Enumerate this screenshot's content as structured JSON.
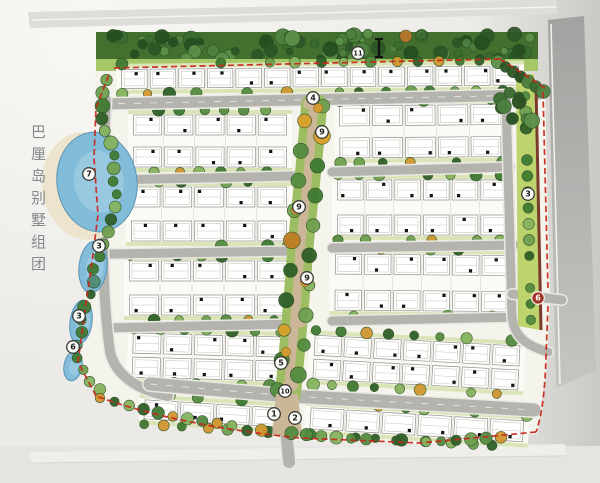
{
  "title": {
    "text": "巴厘岛别墅组团"
  },
  "legend_markers": [
    {
      "label": "11",
      "x": 358,
      "y": 53
    },
    {
      "label": "4",
      "x": 313,
      "y": 98
    },
    {
      "label": "9",
      "x": 322,
      "y": 132
    },
    {
      "label": "7",
      "x": 89,
      "y": 174
    },
    {
      "label": "9",
      "x": 299,
      "y": 207
    },
    {
      "label": "3",
      "x": 99,
      "y": 246
    },
    {
      "label": "3",
      "x": 528,
      "y": 194
    },
    {
      "label": "9",
      "x": 307,
      "y": 278
    },
    {
      "label": "3",
      "x": 79,
      "y": 316
    },
    {
      "label": "6",
      "x": 73,
      "y": 347
    },
    {
      "label": "5",
      "x": 281,
      "y": 363
    },
    {
      "label": "10",
      "x": 285,
      "y": 391
    },
    {
      "label": "1",
      "x": 274,
      "y": 414
    },
    {
      "label": "2",
      "x": 295,
      "y": 418
    },
    {
      "label": "6",
      "x": 538,
      "y": 298,
      "style": "red"
    }
  ],
  "icons": [
    {
      "name": "section-cut-icon",
      "x": 379,
      "y": 48
    },
    {
      "name": "sprout-icon",
      "x": 391,
      "y": 50
    }
  ],
  "colors": {
    "paper": "#eceae6",
    "paper_light": "#f6f5f1",
    "paper_bottom": "#e5e4e0",
    "outer_road_top": "#deddd9",
    "outer_road_right_dark": "#a3a2a0",
    "outer_road_right_light": "#c6c5c2",
    "site_ground": "#f4f3ec",
    "tree_band_dark": "#44702f",
    "lawn_light": "#a5c768",
    "median_green": "#bdd36e",
    "block_fill": "#fbfaf5",
    "block_lawn": "#d9e5b6",
    "road_fill": "#b4b3ae",
    "road_shoulder": "#e9e8e2",
    "water": "#82bcd8",
    "water_edge": "#5894b8",
    "water_highlight": "#a9d2e6",
    "beach": "#ece4cc",
    "boundary_red": "#c8251a",
    "hedge_maroon": "#7a3b2a",
    "spine_path": "#cbb697",
    "villa_fill": "#ffffff",
    "villa_stroke": "#8f8f88",
    "villa_square": "#141414",
    "marker_fill": "#fcfcf9",
    "marker_ring": "#3a3a36",
    "marker_text": "#1c1c1a",
    "entrance_marker_fill": "#a33226",
    "title_color": "#84898d"
  }
}
